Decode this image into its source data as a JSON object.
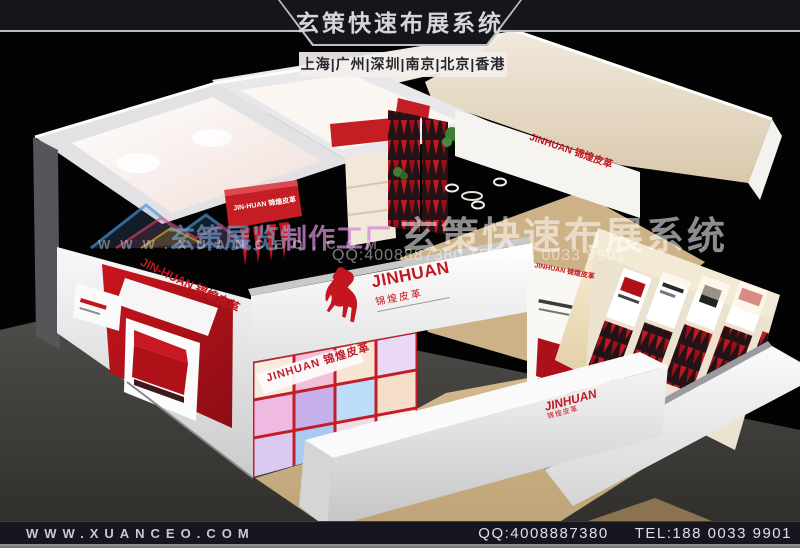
{
  "header": {
    "title": "玄策快速布展系统",
    "cities": "上海|广州|深圳|南京|北京|香港"
  },
  "watermark": {
    "studio": "玄策展览制作工厂",
    "url": "WWW.XUANCEO.COM",
    "system_title": "玄策快速布展系统",
    "contact": "QQ:4008887380 TEL:188 0033 9901"
  },
  "booth": {
    "beam": {
      "en": "JINHUAN",
      "cn": "锦煌皮革"
    },
    "left_panel_brand": "JIN-HUAN 锦煌皮革",
    "interior_beam_label": "JIN-HUAN 锦煌皮革",
    "glass_wall_brand": "JINHUAN 锦煌皮革",
    "back_wall_brand": "JINHUAN 锦煌皮革",
    "desk": {
      "en": "JINHUAN",
      "cn": "锦煌皮革"
    },
    "poster_brand": "JINHUAN 锦煌皮革"
  },
  "footer": {
    "website": "WWW.XUANCEO.COM",
    "qq": "QQ:4008887380",
    "tel": "TEL:188 0033 9901"
  },
  "colors": {
    "accent_red": "#c0161f",
    "floor_tan": "#cdb287",
    "banner_dark": "#15161c"
  }
}
